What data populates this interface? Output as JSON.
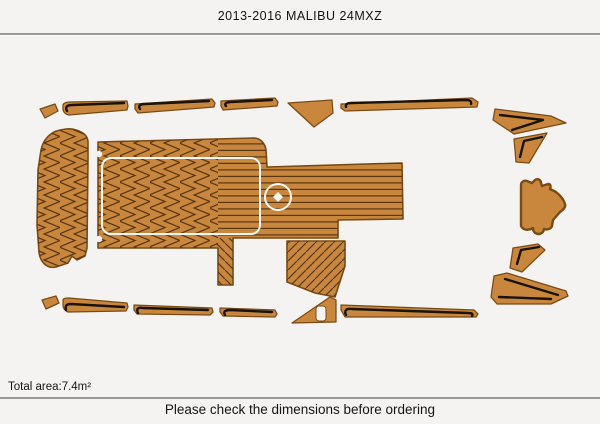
{
  "header": {
    "title": "2013-2016 MALIBU 24MXZ"
  },
  "footer": {
    "total_area": "Total area:7.4m²",
    "note": "Please check the dimensions before ordering"
  },
  "colors": {
    "background": "#f5f3f1",
    "deck": "#c8873d",
    "plank_line": "#5b3710",
    "piece_border": "#7a4a14",
    "accent_stripe": "#1a130b",
    "hatch_outline": "#f8f7f5",
    "divider": "#9a9a9a",
    "text_color": "#141414"
  },
  "diagram": {
    "kind": "boat-deck-template-layout",
    "total_area_m2": 7.4,
    "pieces": [
      "bow-pad",
      "main-cockpit-pad",
      "rear-sunpad",
      "helm-pad",
      "port-gunwale-corner",
      "port-gunwale-trim-1",
      "port-gunwale-trim-2",
      "port-gunwale-trim-3",
      "port-bow-filler",
      "port-gunwale-trim-4",
      "starboard-gunwale-corner",
      "starboard-gunwale-trim-1",
      "starboard-gunwale-trim-2",
      "starboard-gunwale-trim-3",
      "starboard-bow-filler",
      "starboard-gunwale-trim-4",
      "bow-wing-upper",
      "bow-wing-lower",
      "stern-wing-upper",
      "stern-wing-lower"
    ]
  }
}
